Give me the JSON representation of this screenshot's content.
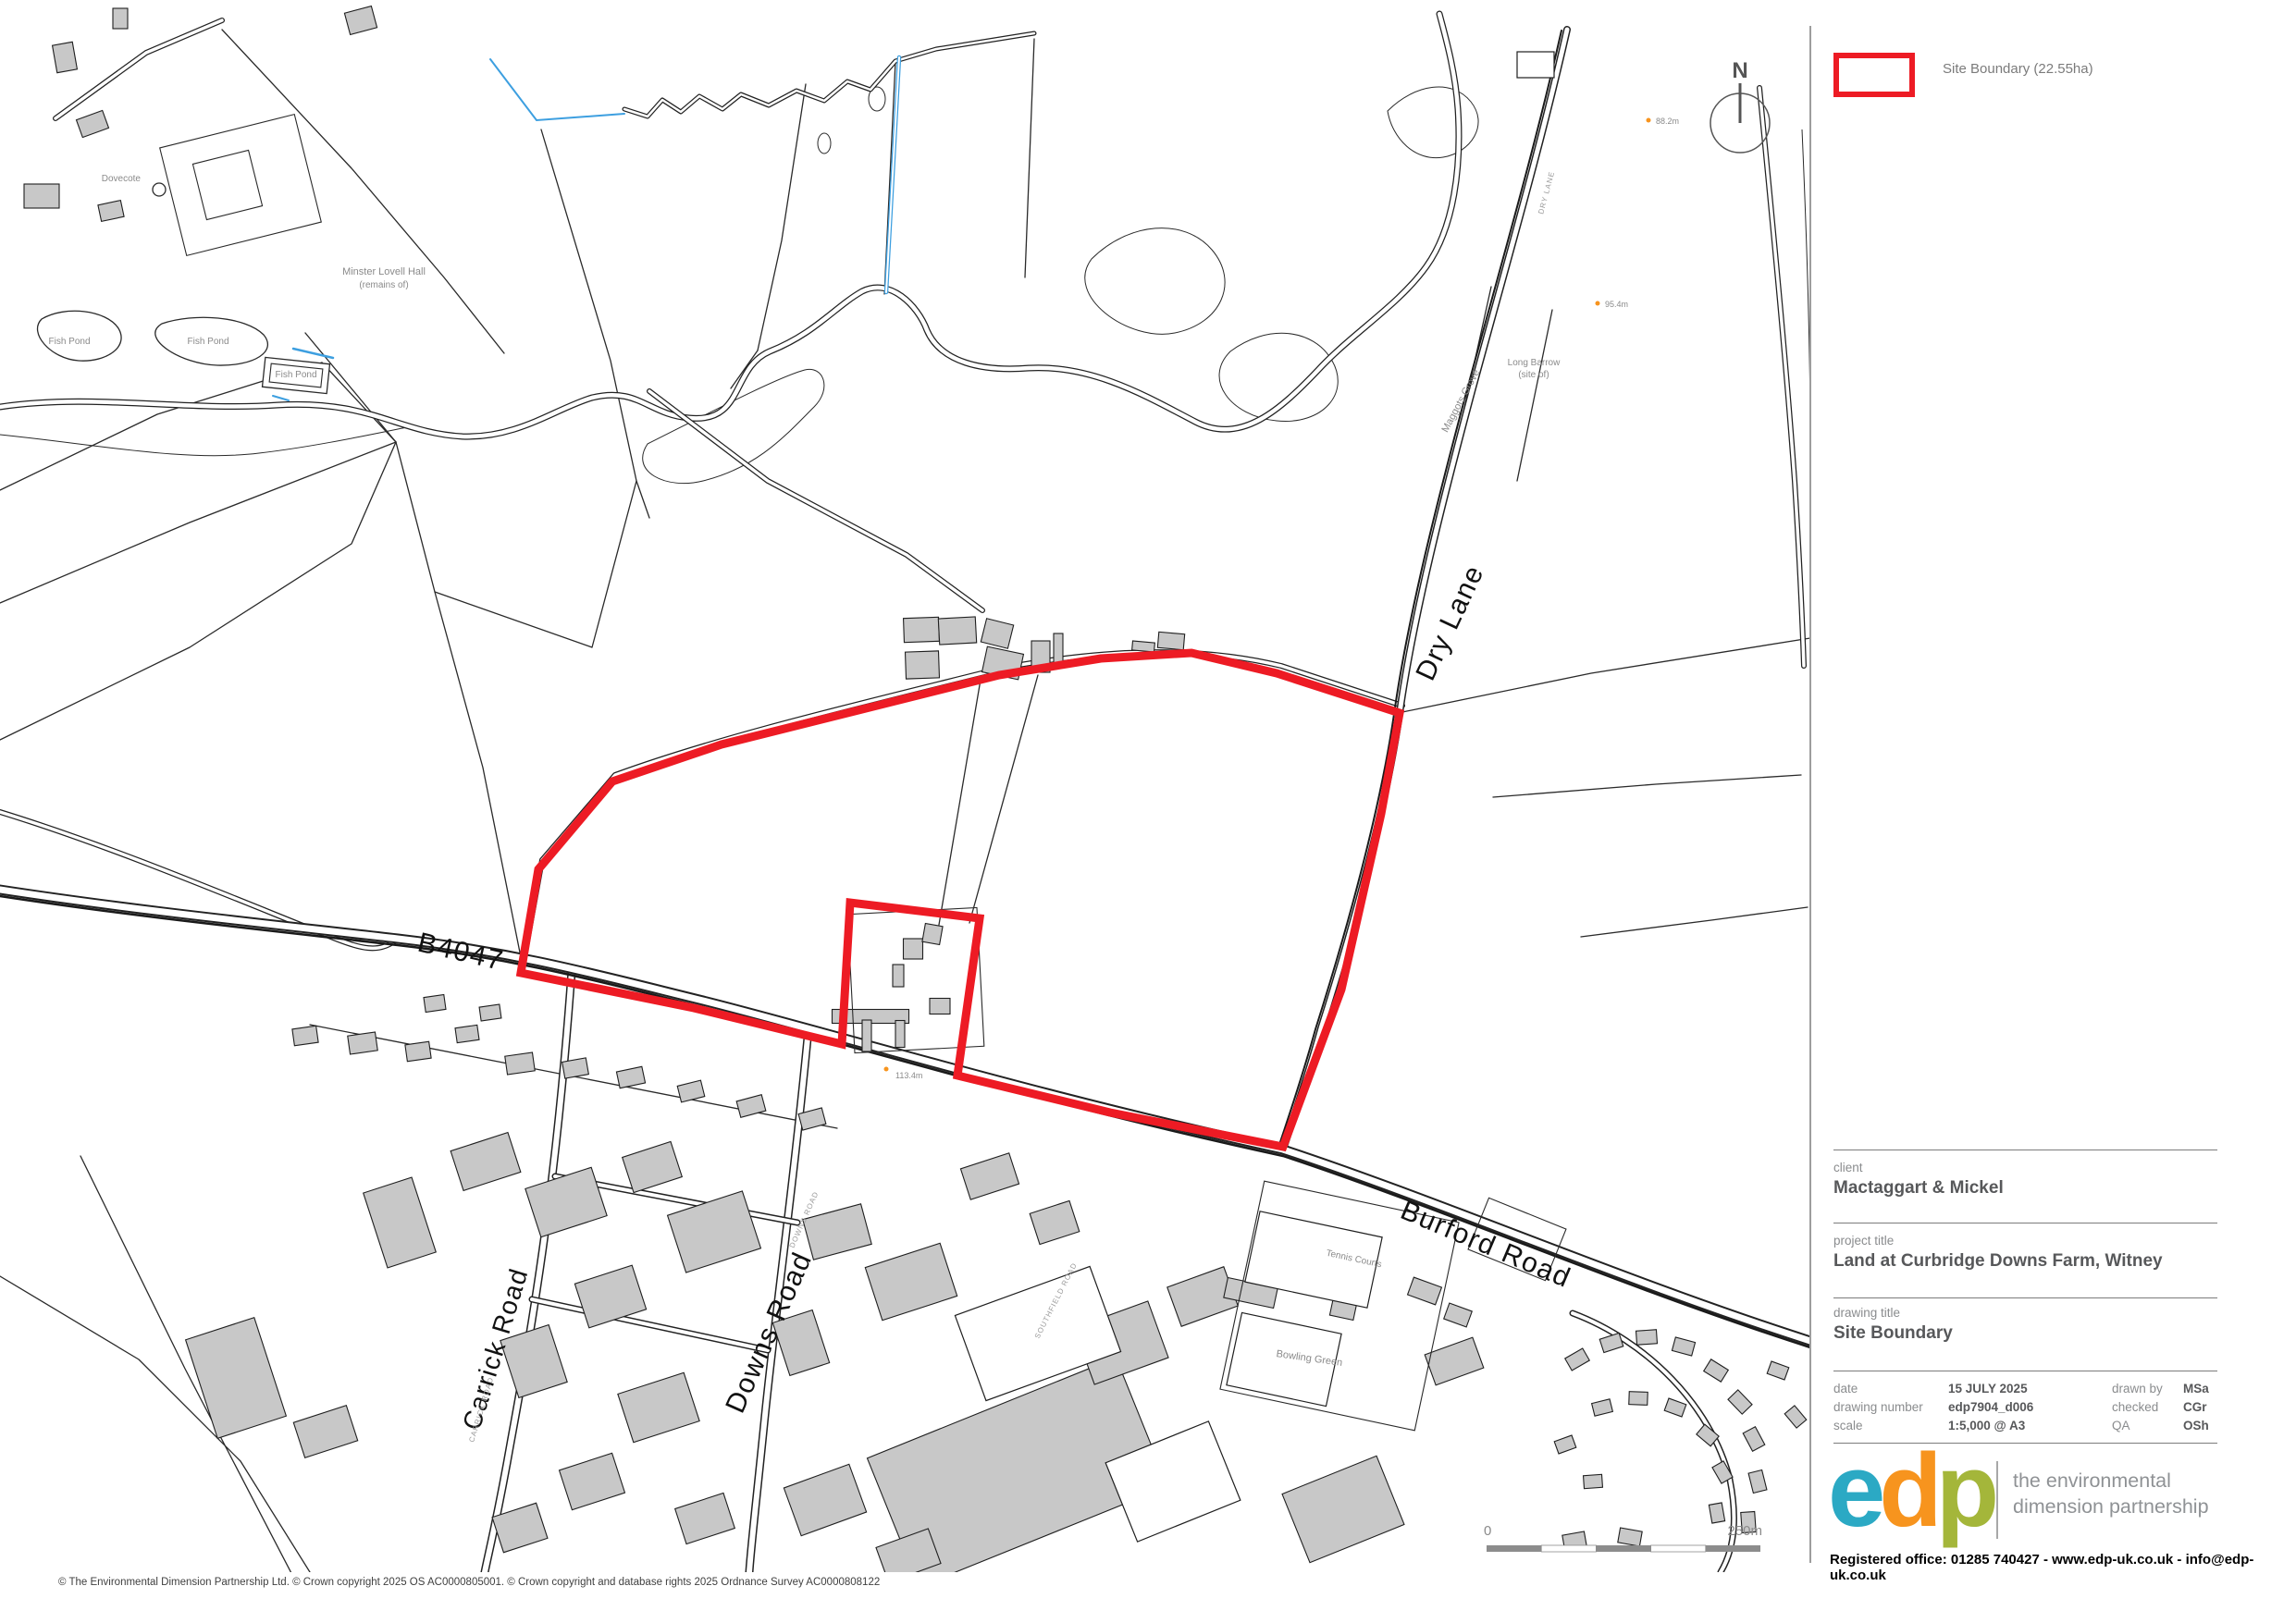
{
  "colors": {
    "site_boundary": "#ed1b24",
    "stream_blue": "#3d9fe0",
    "building_gray": "#c8c8c8",
    "logo_e": "#2ba9c4",
    "logo_d": "#f7941e",
    "logo_p": "#a4b63a"
  },
  "legend": {
    "site_boundary_label": "Site Boundary (22.55ha)"
  },
  "map": {
    "north_label": "N",
    "road_labels": {
      "b4047": "B4047",
      "dry_lane": "Dry Lane",
      "burford_road": "Burford Road",
      "downs_road": "Downs Road",
      "carrick_road": "Carrick Road",
      "dry_lane_small": "DRY LANE",
      "downs_road_small": "DOWNS ROAD",
      "carrick_road_small": "CARRICK ROAD",
      "southfield_road_small": "SOUTHFIELD ROAD"
    },
    "place_labels": {
      "hall_line1": "Minster Lovell Hall",
      "hall_line2": "(remains of)",
      "fish_pond": "Fish Pond",
      "dovecote": "Dovecote",
      "maggots_grove": "Maggots Grove",
      "long_barrow_line1": "Long Barrow",
      "long_barrow_line2": "(site of)",
      "tennis_courts": "Tennis Courts",
      "bowling_green": "Bowling Green"
    },
    "spot_heights": {
      "h1": "88.2m",
      "h2": "95.4m",
      "h3": "113.4m"
    },
    "scale_bar": {
      "start": "0",
      "end": "250m"
    },
    "copyright": "© The Environmental Dimension Partnership Ltd. © Crown copyright 2025 OS AC0000805001. © Crown copyright and database rights 2025 Ordnance Survey AC0000808122"
  },
  "title_block": {
    "client_label": "client",
    "client": "Mactaggart & Mickel",
    "project_title_label": "project title",
    "project_title": "Land at Curbridge Downs Farm, Witney",
    "drawing_title_label": "drawing title",
    "drawing_title": "Site Boundary",
    "date_label": "date",
    "date": "15 JULY 2025",
    "drawing_number_label": "drawing number",
    "drawing_number": "edp7904_d006",
    "scale_label": "scale",
    "scale": "1:5,000 @ A3",
    "drawn_by_label": "drawn by",
    "drawn_by": "MSa",
    "checked_label": "checked",
    "checked": "CGr",
    "qa_label": "QA",
    "qa": "OSh"
  },
  "branding": {
    "logo": {
      "e": "e",
      "d": "d",
      "p": "p"
    },
    "tagline_line1": "the environmental",
    "tagline_line2": "dimension partnership",
    "registered": "Registered office: 01285 740427 - www.edp-uk.co.uk - info@edp-uk.co.uk"
  }
}
